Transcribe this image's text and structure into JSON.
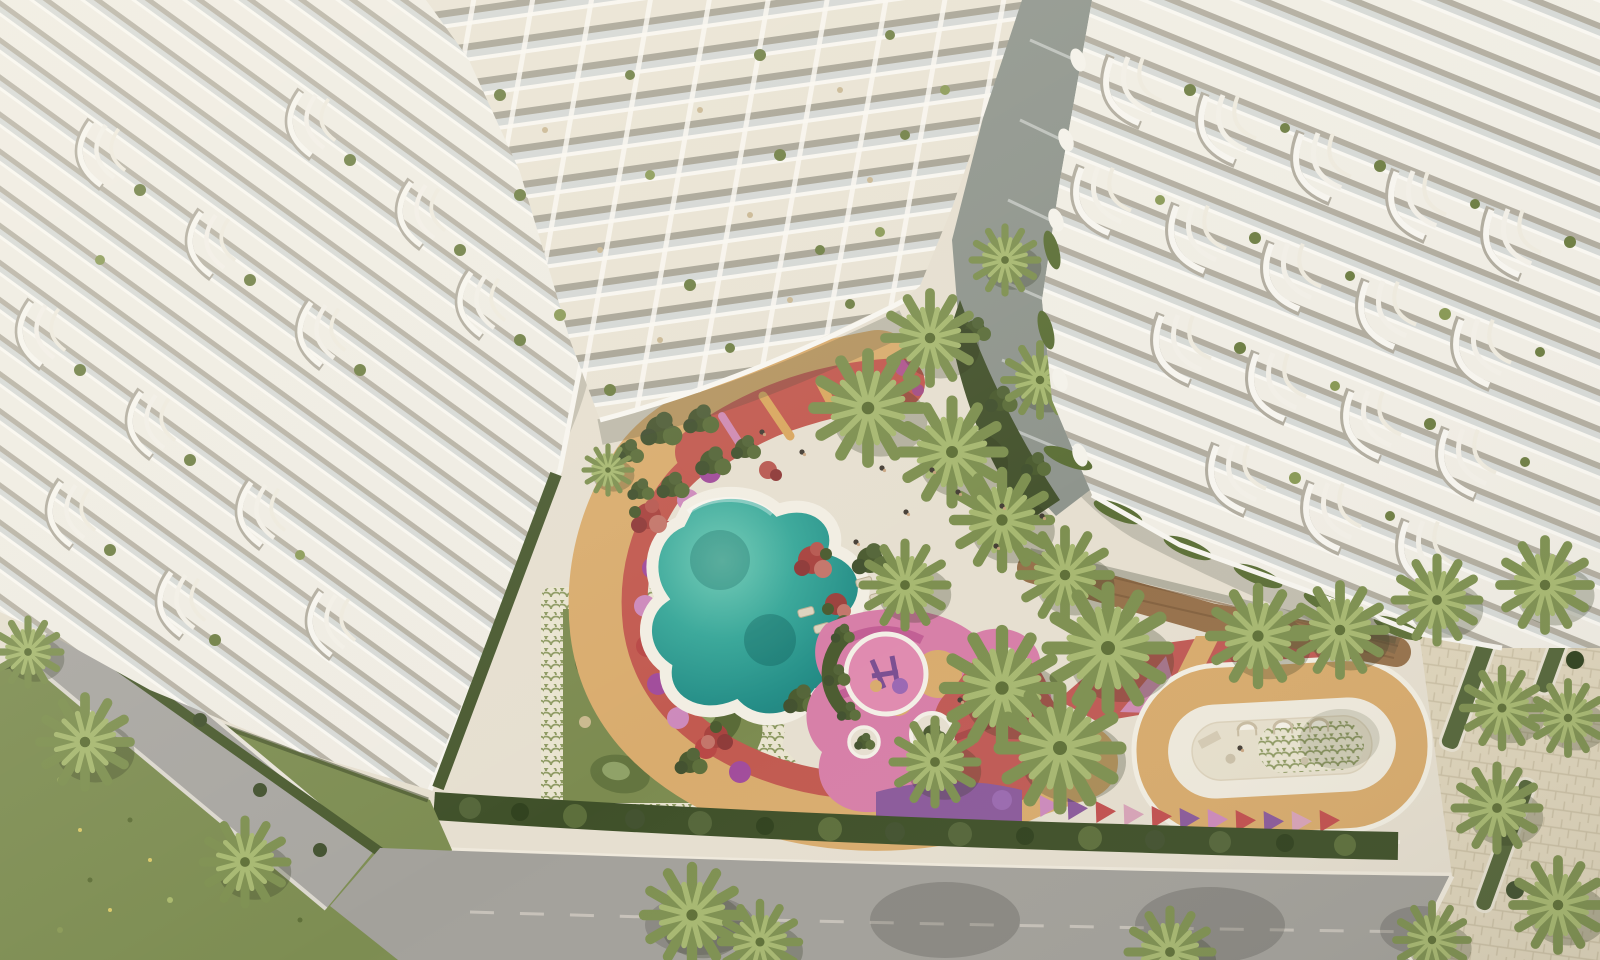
{
  "scene": {
    "description": "Aerial rendering of a white resort-style residential complex: terraced balcony buildings around a landscaped courtyard with a freeform pool, mini-golf lawn, colorful play deck, fitness running loop, palm trees, street lawn and access road",
    "elements": {
      "building_left": "terraced apartment building (left wing)",
      "building_tower": "high-rise balcony tower",
      "building_right": "stepped terrace building (right wing)",
      "courtyard": "landscaped podium courtyard",
      "pool": "freeform swimming pool",
      "lawn": "mini-golf putting lawn",
      "path": "winding promenade path",
      "play_deck": "children's play deck",
      "track": "fitness running loop",
      "deck": "timber deck walkway",
      "hedge": "perimeter hedge row",
      "road": "access road",
      "grass": "street lawn",
      "sidewalk": "paved sidewalk",
      "plaza": "paved side plaza",
      "palms": "palm trees"
    }
  },
  "palette": {
    "plaza": "#e6dfd0",
    "building_white": "#efece3",
    "building_shadow": "#b7b2a5",
    "glass": "#d6d9d6",
    "pool_teal": "#2f9f93",
    "lawn_olive": "#7c8b50",
    "green_dark": "#3f5029",
    "green_mid": "#5d6f3c",
    "palm_green": "#7e9051",
    "palm_light": "#a7b871",
    "mosaic_bg": "#e9e4d0",
    "mosaic_ink": "#8e9a63",
    "path_tan": "#d9ac6e",
    "path_red": "#c25a50",
    "dot_purple": "#a14c9b",
    "dot_pink": "#cd8abc",
    "dot_red": "#b94846",
    "play_pink": "#d77fa8",
    "play_magenta": "#c25f95",
    "play_purple": "#8b5a9b",
    "play_red": "#c05a55",
    "deck_wood": "#96714b",
    "track_tan": "#d8ab6d",
    "track_white": "#efeadd",
    "road_gray": "#a3a19b",
    "grass_green": "#7d8d52",
    "pavers_sand": "#ded4bb"
  }
}
